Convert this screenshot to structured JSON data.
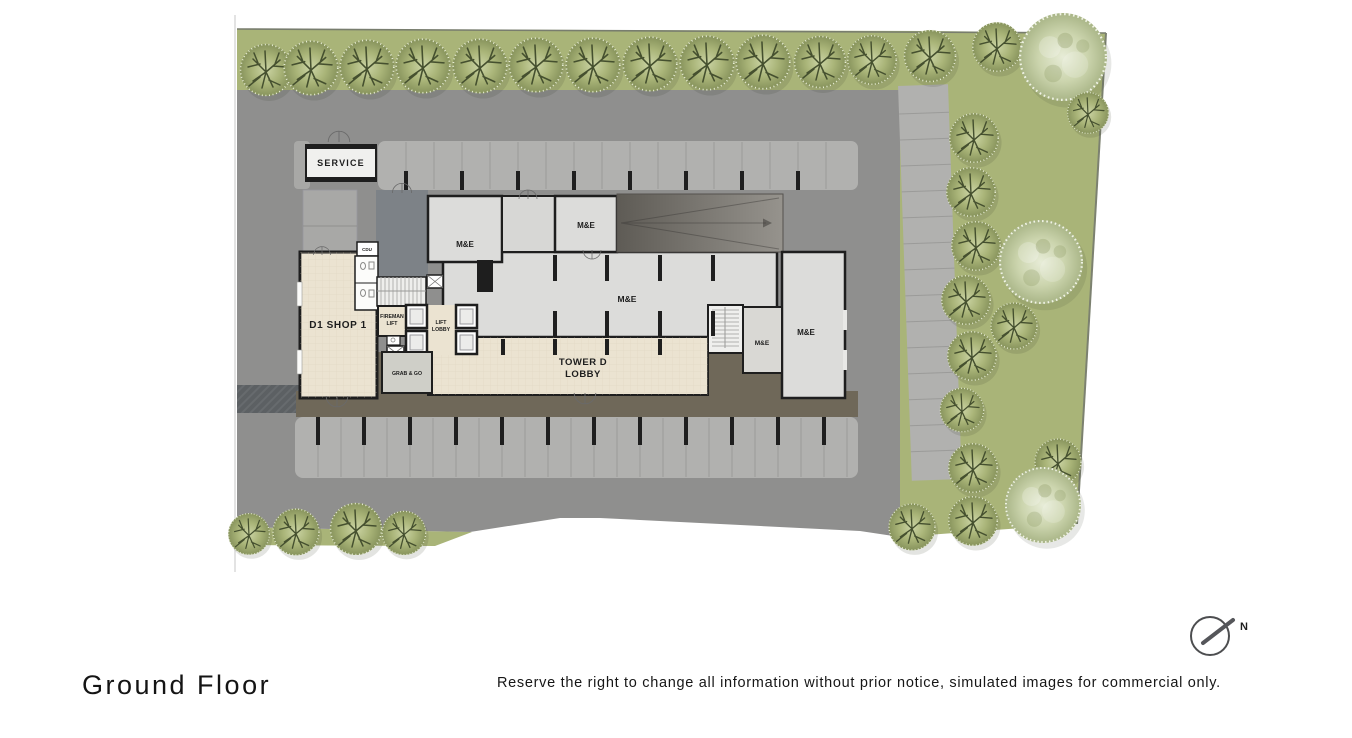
{
  "title": {
    "label": "Ground Floor"
  },
  "disclaimer": {
    "text": "Reserve the right to change all information without prior notice, simulated images for commercial only."
  },
  "compass": {
    "label": "N"
  },
  "plan": {
    "labels": {
      "service": "SERVICE",
      "cdu": "CDU",
      "d1_shop": "D1 SHOP 1",
      "me": "M&E",
      "fireman_lift_line1": "FIREMAN",
      "fireman_lift_line2": "LIFT",
      "lift_lobby_line1": "LIFT",
      "lift_lobby_line2": "LOBBY",
      "grab_and_go": "GRAB & GO",
      "tower_d_lobby_line1": "TOWER D",
      "tower_d_lobby_line2": "LOBBY"
    },
    "colors": {
      "pavement": "#8f8f8e",
      "grass": "#a9b478",
      "parking": "#b1b1af",
      "room": "#dcdcda",
      "lobby_floor": "#ebe3d1",
      "walkway": "#6f6859",
      "wall": "#1e1e1e"
    }
  }
}
